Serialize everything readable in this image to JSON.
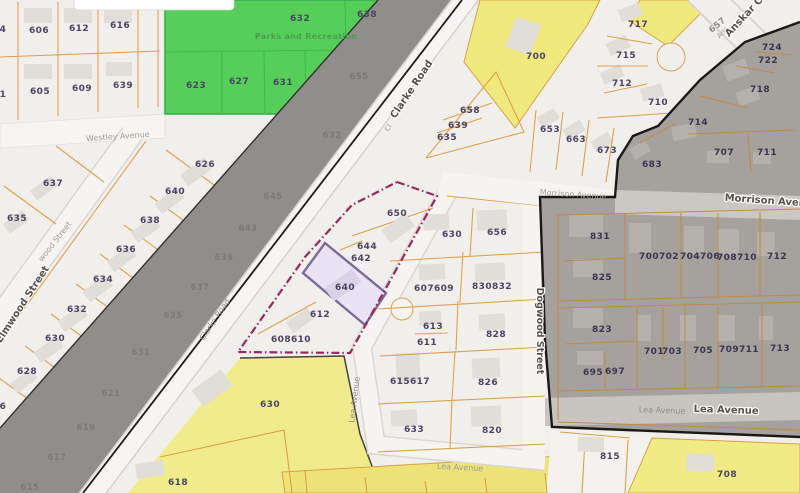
{
  "map": {
    "streets": {
      "westley": "Westley Avenue",
      "elmwood_bold": "Elmwood Street",
      "elmwood_faint": "wood Street",
      "clarke_prefix": "Cl",
      "clarke_upper": "Clarke Road",
      "clarke_lower": "Clarke Road",
      "morrison_faint": "Morrison Avenue",
      "morrison_bold": "Morrison Avenue",
      "anskar_prefix": "Ans",
      "anskar_bold": "Anskar C",
      "dogwood": "Dogwood Street",
      "lea_vertical": "Lea Avenue",
      "lea_bottom": "Lea Avenue",
      "lea_zone_faint": "Lea Avenue",
      "lea_zone_bold": "Lea Avenue"
    },
    "areas": {
      "park_label": "Parks and Recreation"
    },
    "parcels": {
      "grid_nw": [
        "4",
        "606",
        "612",
        "616",
        "1",
        "605",
        "609",
        "639"
      ],
      "elmwood": [
        "637",
        "635",
        "626",
        "640",
        "638",
        "636",
        "634",
        "632",
        "630",
        "628",
        "6"
      ],
      "park": [
        "632",
        "638",
        "623",
        "627",
        "631"
      ],
      "corridor": [
        "657",
        "655",
        "632",
        "645",
        "643",
        "639",
        "637",
        "635",
        "631",
        "621",
        "619",
        "617",
        "615"
      ],
      "flagged": [
        "650",
        "644",
        "642",
        "640",
        "612",
        "608610"
      ],
      "center": [
        "630",
        "656",
        "607609",
        "830832",
        "613",
        "611",
        "828",
        "615617",
        "826",
        "633",
        "820"
      ],
      "fan": [
        "717",
        "715",
        "712",
        "710",
        "700",
        "658",
        "639",
        "635",
        "653",
        "663",
        "673"
      ],
      "zone_north": [
        "724",
        "722",
        "718",
        "714",
        "707",
        "711",
        "683"
      ],
      "zone_mid": [
        "831",
        "825",
        "700702",
        "704706",
        "708710",
        "712"
      ],
      "zone_south": [
        "823",
        "701",
        "703",
        "705",
        "709711",
        "713",
        "695",
        "697"
      ],
      "south": [
        "815",
        "708",
        "630",
        "618"
      ]
    },
    "highlight": {
      "selected_parcel": "640",
      "selected_fill": "#e9e3f3",
      "selected_border": "#7b6b9d",
      "boundary_color": "#97295f"
    },
    "palette": {
      "park_green": "#55cf5a",
      "yellow": "#f0eb85",
      "corridor_gray": "#908e8b",
      "zone_gray": "#a5a29e",
      "parcel_line_orange": "#dfa14c",
      "label_ink": "#4b4563"
    }
  }
}
